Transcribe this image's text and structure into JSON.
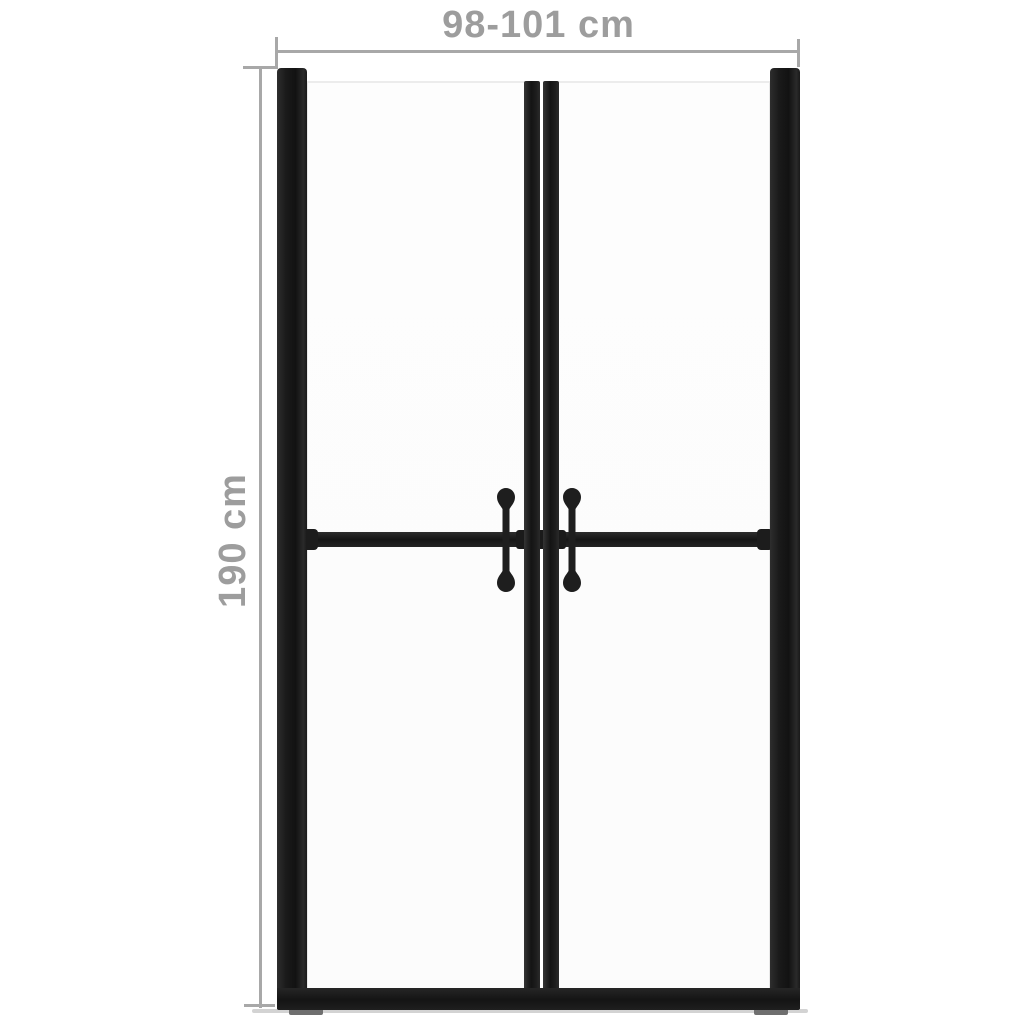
{
  "diagram": {
    "type": "product-dimension-diagram",
    "subject": "double shower door with black frame, two glass panels, mid rail and two vertical handles",
    "width_dimension": {
      "label": "98-101 cm"
    },
    "height_dimension": {
      "label": "190 cm"
    }
  },
  "colors": {
    "background": "#ffffff",
    "dim_line": "#a8a8a8",
    "dim_text": "#9d9d9d",
    "frame": "#1c1c1c",
    "glass": "#fcfcfc",
    "glass_border": "#e8e8e8",
    "shadow": "#c8c8c8",
    "foot": "#6f6f6f"
  }
}
